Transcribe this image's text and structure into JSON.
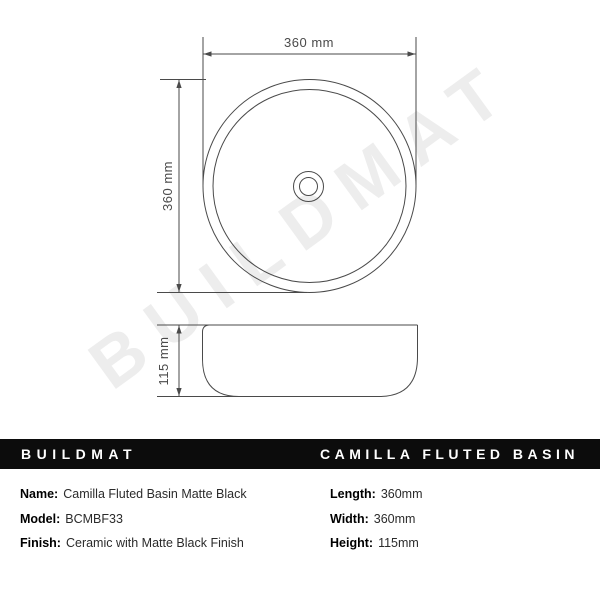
{
  "watermark": {
    "text": "BUILDMAT"
  },
  "drawing": {
    "top_view_width_label": "360 mm",
    "top_view_height_label": "360 mm",
    "side_view_height_label": "115 mm"
  },
  "banner": {
    "brand": "BUILDMAT",
    "product_title": "CAMILLA FLUTED BASIN"
  },
  "specs": {
    "left": [
      {
        "label": "Name:",
        "value": "Camilla Fluted Basin Matte Black"
      },
      {
        "label": "Model:",
        "value": "BCMBF33"
      },
      {
        "label": "Finish:",
        "value": "Ceramic with Matte Black Finish"
      }
    ],
    "right": [
      {
        "label": "Length:",
        "value": "360mm"
      },
      {
        "label": "Width:",
        "value": "360mm"
      },
      {
        "label": "Height:",
        "value": "115mm"
      }
    ]
  },
  "colors": {
    "line": "#4a4a4a",
    "watermark": "#ededed",
    "banner_bg": "#0c0c0c",
    "banner_fg": "#ffffff"
  }
}
